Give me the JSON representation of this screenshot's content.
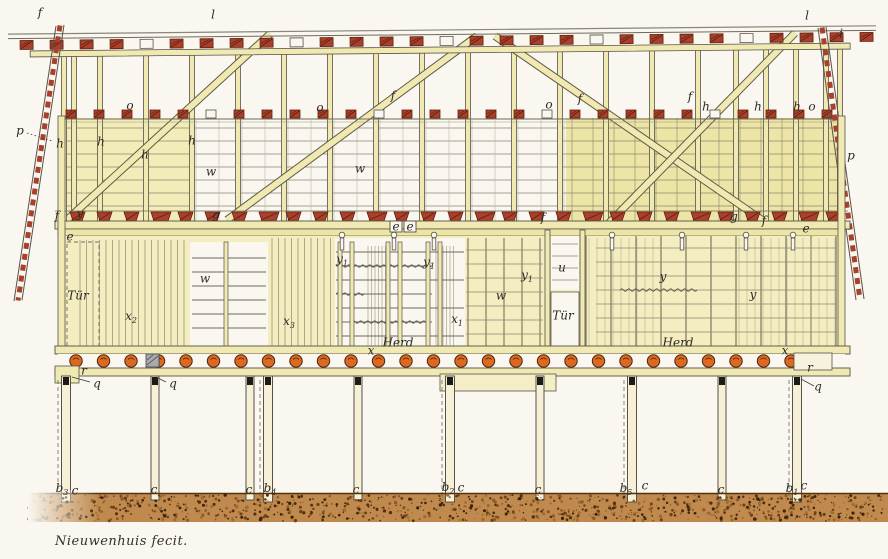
{
  "caption": "Nieuwenhuis fecit.",
  "door_label": "Tür",
  "hearth_label": "Herd",
  "colors": {
    "paper": "#f9f7ef",
    "wood": "#f0e9b2",
    "wood_deep": "#ece5a6",
    "wood_light": "#f5f0d6",
    "line": "#57524a",
    "grid": "#8d8772",
    "red": "#a8402c",
    "red_dark": "#63200f",
    "orange": "#dd6820",
    "orange_dark": "#4a250e",
    "ground": "#c08a4e",
    "ground_dark": "#53320f",
    "ink": "#2e2b25"
  },
  "labels": [
    {
      "text": "f",
      "x": 40,
      "y": 13
    },
    {
      "text": "l",
      "x": 213,
      "y": 15
    },
    {
      "text": "l",
      "x": 807,
      "y": 16
    },
    {
      "text": "i",
      "x": 841,
      "y": 34
    },
    {
      "text": "p",
      "x": 20,
      "y": 131
    },
    {
      "text": "p",
      "x": 851,
      "y": 156
    },
    {
      "text": "o",
      "x": 130,
      "y": 106
    },
    {
      "text": "o",
      "x": 320,
      "y": 108
    },
    {
      "text": "o",
      "x": 549,
      "y": 105
    },
    {
      "text": "o",
      "x": 812,
      "y": 107
    },
    {
      "text": "h",
      "x": 60,
      "y": 144
    },
    {
      "text": "h",
      "x": 101,
      "y": 142
    },
    {
      "text": "h",
      "x": 145,
      "y": 155
    },
    {
      "text": "h",
      "x": 192,
      "y": 141
    },
    {
      "text": "h",
      "x": 706,
      "y": 107
    },
    {
      "text": "h",
      "x": 758,
      "y": 107
    },
    {
      "text": "h",
      "x": 797,
      "y": 107
    },
    {
      "text": "f",
      "x": 393,
      "y": 96
    },
    {
      "text": "f",
      "x": 580,
      "y": 99
    },
    {
      "text": "f",
      "x": 690,
      "y": 97
    },
    {
      "text": "w",
      "x": 211,
      "y": 172
    },
    {
      "text": "w",
      "x": 360,
      "y": 169
    },
    {
      "text": "f",
      "x": 57,
      "y": 216
    },
    {
      "text": "y",
      "x": 80,
      "y": 214
    },
    {
      "text": "g",
      "x": 216,
      "y": 215
    },
    {
      "text": "f",
      "x": 543,
      "y": 218
    },
    {
      "text": "g",
      "x": 734,
      "y": 217
    },
    {
      "text": "f",
      "x": 764,
      "y": 221
    },
    {
      "text": "e",
      "x": 806,
      "y": 229
    },
    {
      "text": "e",
      "x": 70,
      "y": 237
    },
    {
      "text": "e",
      "x": 396,
      "y": 227
    },
    {
      "text": "e",
      "x": 410,
      "y": 227
    },
    {
      "text": "Tür",
      "x": 78,
      "y": 296
    },
    {
      "text": "x",
      "sub": "2",
      "x": 131,
      "y": 318
    },
    {
      "text": "w",
      "x": 205,
      "y": 279
    },
    {
      "text": "x",
      "sub": "3",
      "x": 289,
      "y": 323
    },
    {
      "text": "y",
      "sub": "1",
      "x": 342,
      "y": 261
    },
    {
      "text": "y",
      "sub": "1",
      "x": 429,
      "y": 264
    },
    {
      "text": "y",
      "sub": "1",
      "x": 527,
      "y": 277
    },
    {
      "text": "w",
      "x": 501,
      "y": 296
    },
    {
      "text": "x",
      "sub": "1",
      "x": 457,
      "y": 321
    },
    {
      "text": "Herd",
      "x": 398,
      "y": 343
    },
    {
      "text": "x",
      "x": 371,
      "y": 351
    },
    {
      "text": "u",
      "x": 562,
      "y": 268
    },
    {
      "text": "Tür",
      "x": 563,
      "y": 316
    },
    {
      "text": "y",
      "x": 663,
      "y": 277
    },
    {
      "text": "y",
      "x": 753,
      "y": 295
    },
    {
      "text": "Herd",
      "x": 678,
      "y": 343
    },
    {
      "text": "x",
      "x": 785,
      "y": 351
    },
    {
      "text": "r",
      "x": 84,
      "y": 371
    },
    {
      "text": "q",
      "x": 97,
      "y": 384
    },
    {
      "text": "q",
      "x": 173,
      "y": 384
    },
    {
      "text": "r",
      "x": 810,
      "y": 368
    },
    {
      "text": "q",
      "x": 818,
      "y": 387
    },
    {
      "text": "b",
      "sub": "3",
      "x": 62,
      "y": 490
    },
    {
      "text": "c",
      "x": 75,
      "y": 491
    },
    {
      "text": "c",
      "x": 154,
      "y": 490
    },
    {
      "text": "c",
      "x": 249,
      "y": 490
    },
    {
      "text": "b",
      "sub": "4",
      "x": 270,
      "y": 490
    },
    {
      "text": "c",
      "x": 356,
      "y": 490
    },
    {
      "text": "b",
      "sub": "2",
      "x": 448,
      "y": 489
    },
    {
      "text": "c",
      "x": 461,
      "y": 488
    },
    {
      "text": "c",
      "x": 538,
      "y": 490
    },
    {
      "text": "b",
      "sub": "5",
      "x": 626,
      "y": 490
    },
    {
      "text": "c",
      "x": 645,
      "y": 486
    },
    {
      "text": "c",
      "x": 721,
      "y": 490
    },
    {
      "text": "b",
      "sub": "1",
      "x": 792,
      "y": 490
    },
    {
      "text": "c",
      "x": 804,
      "y": 486
    }
  ]
}
